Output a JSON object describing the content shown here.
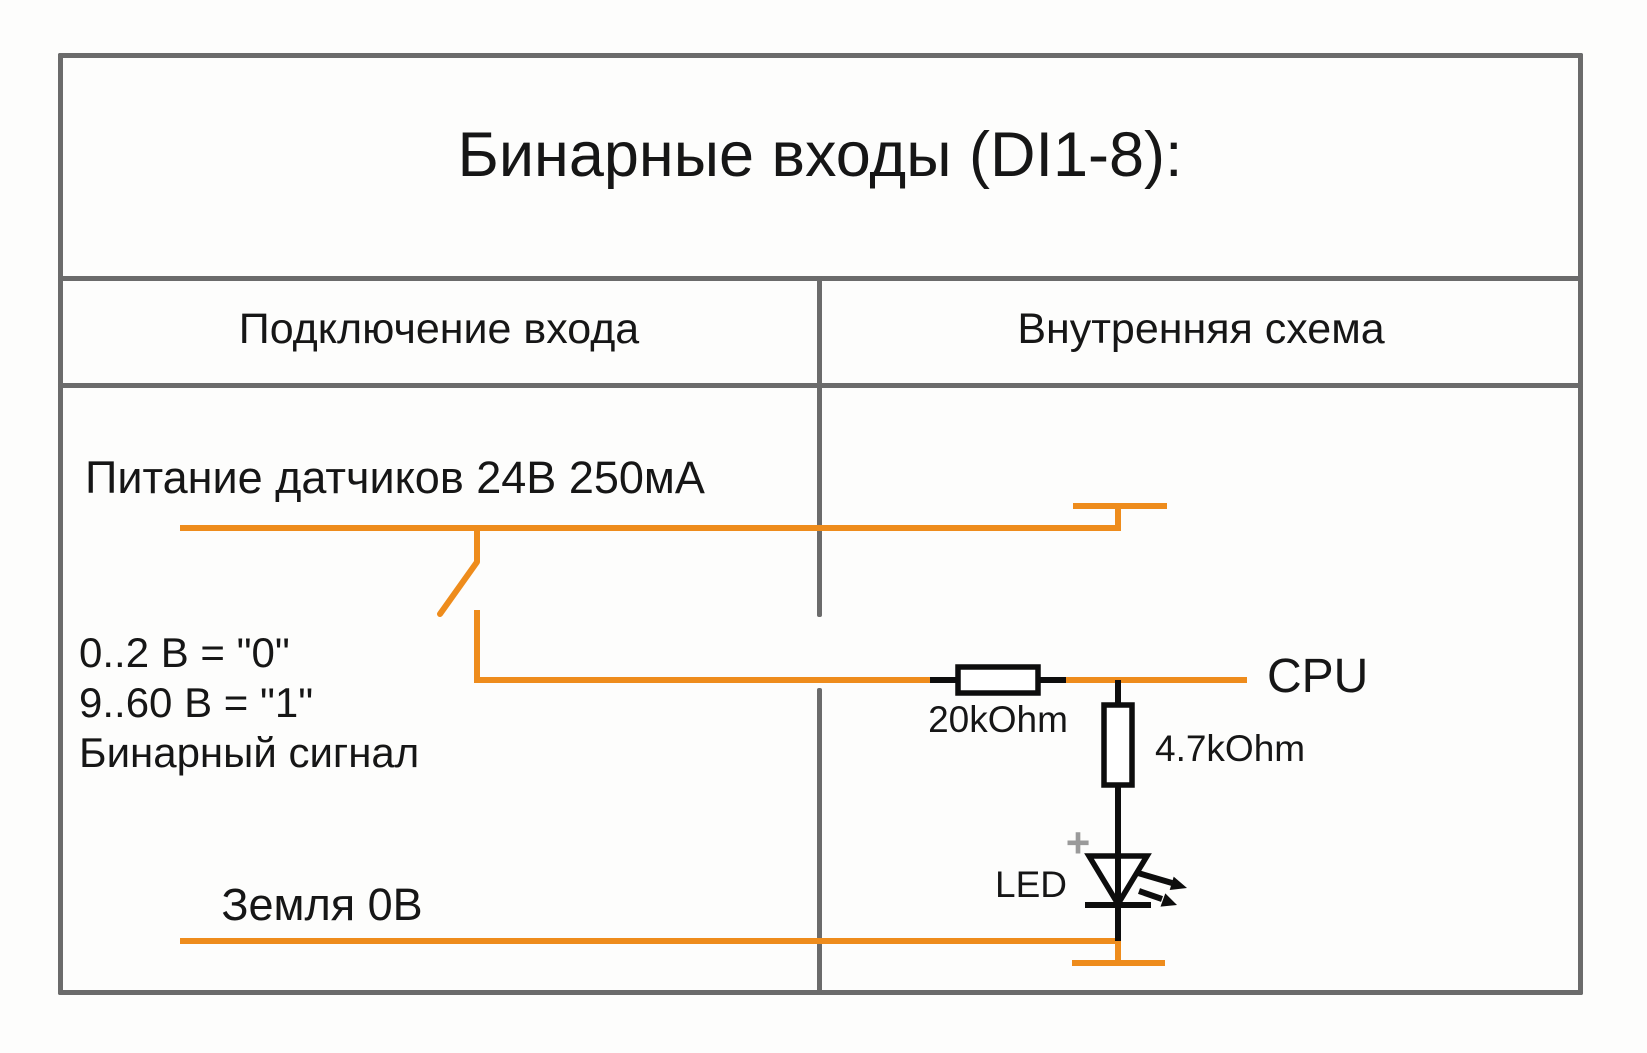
{
  "diagram": {
    "title": "Бинарные входы (DI1-8):",
    "columns": {
      "left_header": "Подключение входа",
      "right_header": "Внутренняя схема"
    },
    "input_connection": {
      "power_label": "Питание датчиков 24В 250мА",
      "level_line1": "0..2 В = \"0\"",
      "level_line2": "9..60 В = \"1\"",
      "level_line3": "Бинарный сигнал",
      "ground_label": "Земля 0В"
    },
    "internal_circuit": {
      "series_resistor_label": "20kOhm",
      "shunt_resistor_label": "4.7kOhm",
      "cpu_label": "CPU",
      "led_label": "LED",
      "led_polarity": "+"
    },
    "colors": {
      "wire_orange": "#EE8C1C",
      "grid_gray": "#6B6B6B",
      "circuit_black": "#0D0D0D",
      "polarity_gray": "#9A9A9A",
      "text_black": "#161616"
    }
  }
}
